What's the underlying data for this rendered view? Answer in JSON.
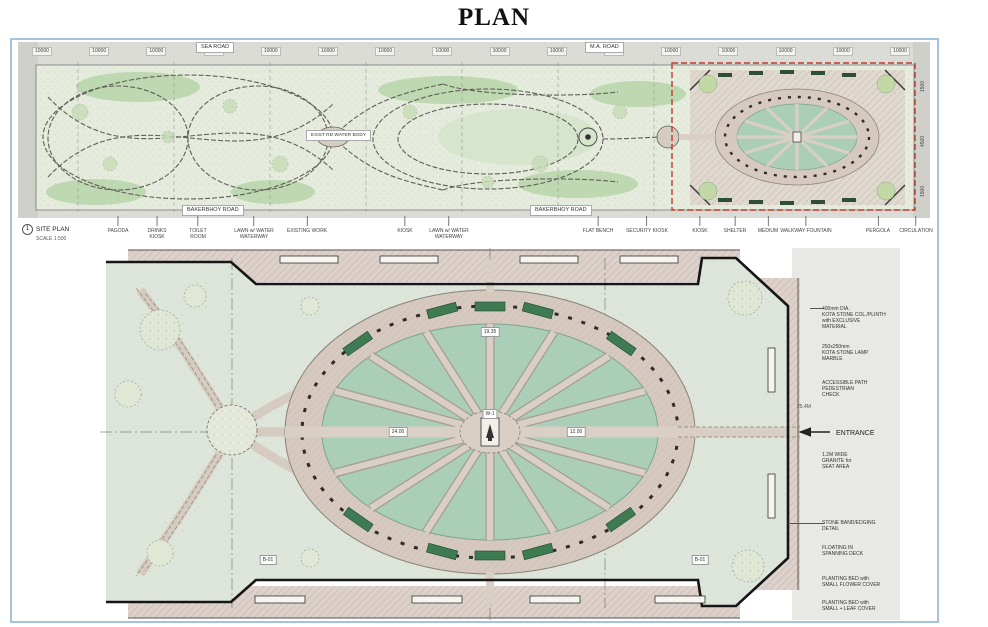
{
  "page": {
    "title": "PLAN"
  },
  "colors": {
    "sheet_border": "#a4c4dd",
    "pond_green": "#abceb8",
    "path_beige": "#d9cfc4",
    "field_green": "#dee5da",
    "detail_box_red": "#c0392b",
    "planter_green": "#3e7b52",
    "boundary_black": "#161616"
  },
  "sheet1": {
    "name_label": "SITE PLAN",
    "scale_label": "SCALE 1:500",
    "sheet_number": "1",
    "road_top_left": "SEA ROAD",
    "road_top_right": "M.A. ROAD",
    "water_body_label": "EXIST RD WATER BODY",
    "road_bottom_left": "BAKERBHOY ROAD",
    "road_bottom_right": "BAKERBHOY ROAD",
    "dim_labels": [
      "10000",
      "10000",
      "10000",
      "10000",
      "10000",
      "10000",
      "10000",
      "10000",
      "10000",
      "10000",
      "10000",
      "10000",
      "10000",
      "10000",
      "10000",
      "10000"
    ],
    "dims_right": [
      "1500",
      "4500",
      "1500"
    ],
    "legend": [
      {
        "x": 118,
        "lines": [
          "PAGODA"
        ]
      },
      {
        "x": 157,
        "lines": [
          "DRINKS",
          "KIOSK"
        ]
      },
      {
        "x": 198,
        "lines": [
          "TOILET",
          "ROOM"
        ]
      },
      {
        "x": 254,
        "lines": [
          "LAWN w/ WATER",
          "WATERWAY"
        ]
      },
      {
        "x": 307,
        "lines": [
          "EXISTING WORK"
        ]
      },
      {
        "x": 405,
        "lines": [
          "KIOSK"
        ]
      },
      {
        "x": 449,
        "lines": [
          "LAWN w/ WATER",
          "WATERWAY"
        ]
      },
      {
        "x": 598,
        "lines": [
          "FLAT BENCH"
        ]
      },
      {
        "x": 647,
        "lines": [
          "SECURITY KIOSK"
        ]
      },
      {
        "x": 700,
        "lines": [
          "KIOSK"
        ]
      },
      {
        "x": 735,
        "lines": [
          "SHELTER"
        ]
      },
      {
        "x": 768,
        "lines": [
          "MEDIUM"
        ]
      },
      {
        "x": 806,
        "lines": [
          "WALKWAY FOUNTAIN"
        ]
      },
      {
        "x": 878,
        "lines": [
          "PERGOLA"
        ]
      },
      {
        "x": 916,
        "lines": [
          "CIRCULATION"
        ]
      }
    ]
  },
  "sheet2": {
    "entrance_label": "ENTRANCE",
    "dim_chip": "25.4M",
    "plan_chips": [
      {
        "x": 490,
        "y": 332,
        "text": "19.35"
      },
      {
        "x": 398,
        "y": 432,
        "text": "24.00"
      },
      {
        "x": 576,
        "y": 432,
        "text": "12.00"
      },
      {
        "x": 490,
        "y": 414,
        "text": "W-1"
      },
      {
        "x": 268,
        "y": 560,
        "text": "B-01"
      },
      {
        "x": 700,
        "y": 560,
        "text": "B-01"
      }
    ],
    "notes": [
      {
        "y": 306,
        "lines": [
          "400mm DIA.",
          "KOTA STONE COL./PLINTH",
          "with EXCLUSIVE",
          "MATERIAL"
        ]
      },
      {
        "y": 344,
        "lines": [
          "250x250mm",
          "KOTA STONE LAMP",
          "MARBLE"
        ]
      },
      {
        "y": 380,
        "lines": [
          "ACCESSIBLE PATH",
          "PEDESTRIAN",
          "CHECK"
        ]
      },
      {
        "y": 452,
        "lines": [
          "1.2M WIDE",
          "GRANITE for",
          "SEAT AREA"
        ]
      },
      {
        "y": 520,
        "lines": [
          "STONE BAND/EDGING",
          "DETAIL"
        ]
      },
      {
        "y": 545,
        "lines": [
          "FLOATING IN",
          "SPANNING DECK"
        ]
      },
      {
        "y": 576,
        "lines": [
          "PLANTING BED with",
          "SMALL FLOWER COVER"
        ]
      },
      {
        "y": 600,
        "lines": [
          "PLANTING BED with",
          "SMALL + LEAF COVER"
        ]
      }
    ]
  }
}
